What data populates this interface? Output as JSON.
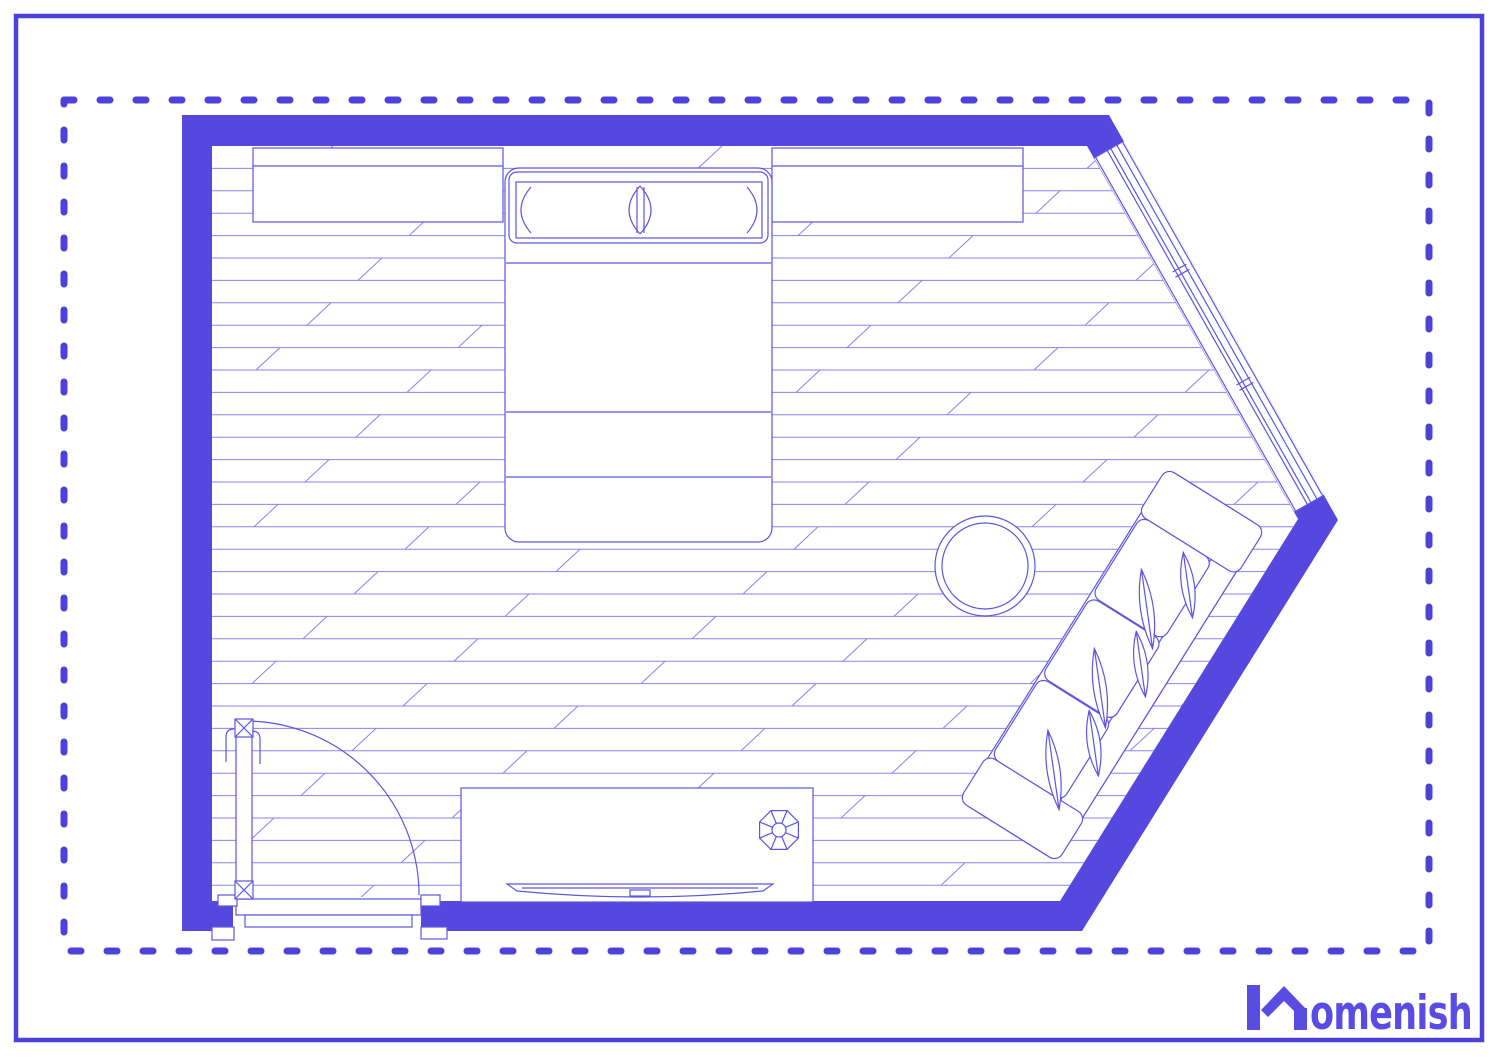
{
  "page": {
    "background": "#ffffff",
    "outer_border_color": "#4c41d8",
    "dashed_border_color": "#4c41d8"
  },
  "floor_plan": {
    "room_type": "bedroom",
    "wall_color": "#5448de",
    "outline_color": "#5f54df",
    "floor_line_color": "#8a82ec",
    "floor": {
      "plank_spacing": 22.4,
      "joint_run": 24,
      "top": 146,
      "bottom": 901,
      "left": 212,
      "right": 1330
    },
    "window": {
      "band_width": 34,
      "start_t": 30,
      "end_t": 437,
      "line_offsets": [
        1.5,
        8,
        15,
        19,
        32.5
      ],
      "mullions_t": [
        168,
        174,
        298,
        304
      ]
    },
    "furniture": [
      {
        "name": "wardrobe-left"
      },
      {
        "name": "double-bed"
      },
      {
        "name": "wardrobe-right"
      },
      {
        "name": "corner-window"
      },
      {
        "name": "sofa"
      },
      {
        "name": "round-side-table"
      },
      {
        "name": "desk"
      },
      {
        "name": "desk-fan"
      },
      {
        "name": "tv-screen"
      },
      {
        "name": "door"
      }
    ]
  },
  "logo": {
    "text": "omenish",
    "full_name": "Homenish",
    "color": "#584ce2"
  }
}
